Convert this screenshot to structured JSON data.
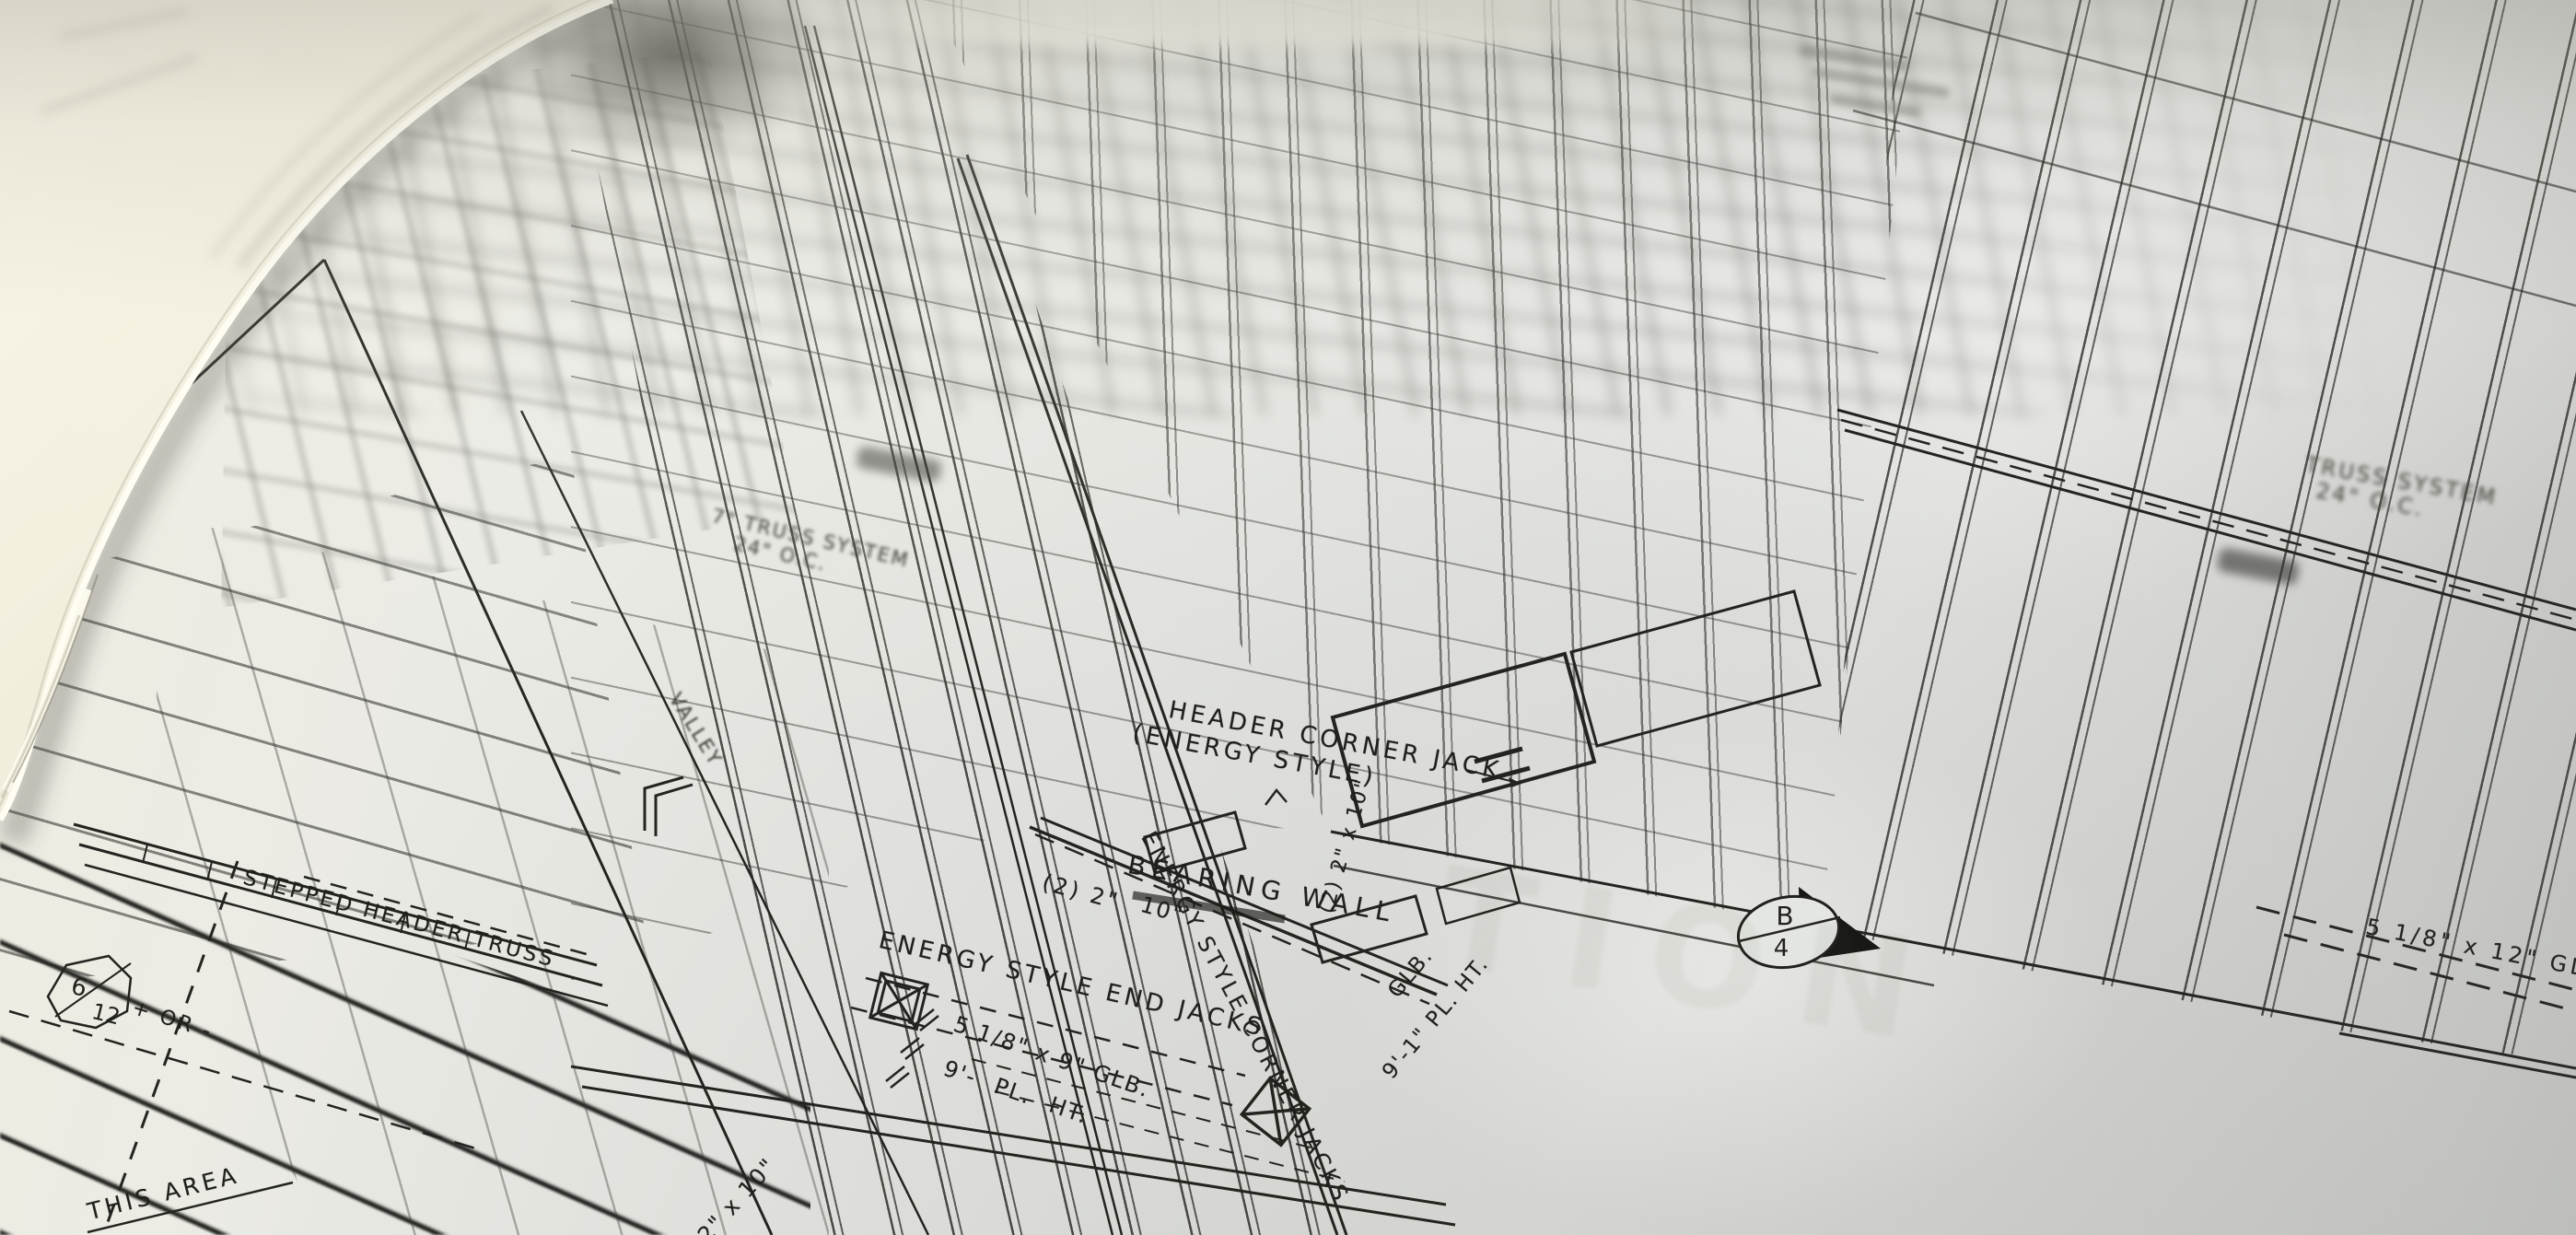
{
  "scene": {
    "type": "photograph",
    "subject": "Rolled architectural blueprint - wood framing plan, shallow depth of field, page curled at top left",
    "paper_color": "#e8e9e5",
    "curl_color": "#f5f2e2",
    "ink_color": "#23231f"
  },
  "labels": {
    "header_corner_jack_1": "HEADER CORNER JACK",
    "header_corner_jack_2": "(ENERGY STYLE)",
    "bearing_wall": "BEARING WALL",
    "corner_jacks_diag": "ENERGY STYLE CORNER JACKS",
    "end_jacks": "ENERGY STYLE END JACKS",
    "glb_5x9": "5 1/8\" x 9\" GLB.",
    "pl_ht_9": "9'-  PL. HT.",
    "stepped_header": "STEPPED HEADER TRUSS",
    "pitch_top": "6",
    "pitch_bottom": "12",
    "pitch_tolerance": "+ OR -",
    "this_area": "THIS AREA",
    "valley": "VALLEY",
    "truss_system_left_1": "7\" TRUSS SYSTEM",
    "truss_system_left_2": "24\" O.C.",
    "truss_system_right_1": "TRUSS SYSTEM",
    "truss_system_right_2": "24\" O.C.",
    "glb_5x12": "5 1/8\" x 12\" GLB",
    "double_2x10_a": "(2) 2\"",
    "double_2x10_b": "10\"",
    "double_2x10_vert": "(2) 2\" x 10\"",
    "glb_vert": "GLB.",
    "pl_ht_9_1": "9'-1\" PL. HT.",
    "joist_2x10": "2\" x 10\"",
    "section_letter": "B",
    "section_number": "4",
    "watermark_ghost": "TION"
  }
}
